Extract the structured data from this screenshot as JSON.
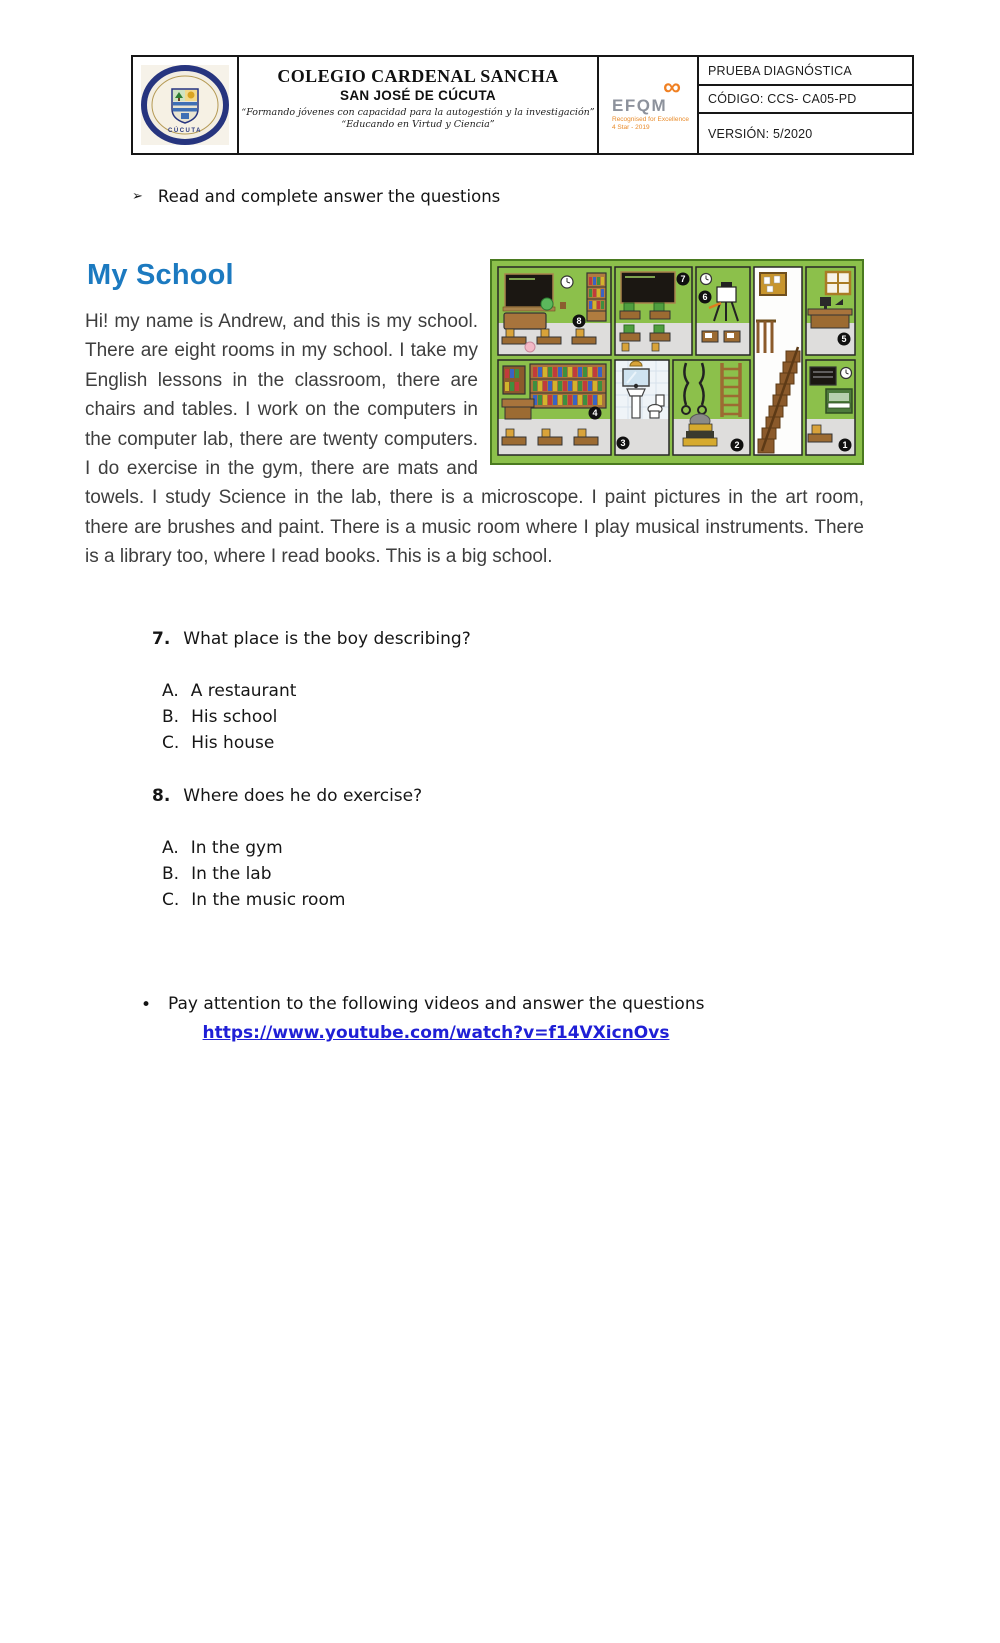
{
  "header": {
    "logo": {
      "top_text": "COLEGIO CARDENAL SANCHA",
      "bottom_text": "CÚCUTA"
    },
    "school_name": "COLEGIO CARDENAL SANCHA",
    "school_city": "SAN JOSÉ DE CÚCUTA",
    "motto_line1": "“Formando jóvenes con capacidad para la autogestión y la investigación”",
    "motto_line2": "“Educando en Virtud y Ciencia”",
    "efqm": {
      "symbol": "∞",
      "label": "EFQM",
      "sub1": "Recognised for Excellence",
      "sub2": "4 Star - 2019"
    },
    "info_rows": [
      "PRUEBA DIAGNÓSTICA",
      "CÓDIGO: CCS- CA05-PD",
      "VERSIÓN: 5/2020"
    ]
  },
  "instruction": {
    "bullet": "➢",
    "text": "Read and complete answer the questions"
  },
  "reading": {
    "title": "My School",
    "paragraph": "Hi! my name is Andrew, and this is my school. There are eight rooms in my school. I take my English lessons in the classroom, there are chairs and tables. I work on the computers in the computer lab, there are twenty computers. I do exercise in the gym, there are mats and towels. I study Science in the lab, there is a microscope. I paint pictures in the art room, there are brushes and paint. There is a music room where I play musical instruments. There is a library too, where I read books. This is a big school."
  },
  "school_image": {
    "room_numbers": [
      "8",
      "7",
      "6",
      "5",
      "4",
      "3",
      "2",
      "1"
    ]
  },
  "questions": [
    {
      "number": "7.",
      "text": "What place is the boy describing?",
      "options": [
        {
          "label": "A.",
          "text": "A restaurant"
        },
        {
          "label": "B.",
          "text": "His school"
        },
        {
          "label": "C.",
          "text": "His house"
        }
      ]
    },
    {
      "number": "8.",
      "text": "Where does he do exercise?",
      "options": [
        {
          "label": "A.",
          "text": "In the gym"
        },
        {
          "label": "B.",
          "text": "In the lab"
        },
        {
          "label": "C.",
          "text": "In the music room"
        }
      ]
    }
  ],
  "video_section": {
    "bullet": "•",
    "text": "Pay attention to the following videos and answer the questions",
    "link_text": "https://www.youtube.com/watch?v=f14VXicnOvs",
    "link_href": "https://www.youtube.com/watch?v=f14VXicnOvs"
  },
  "colors": {
    "title_blue": "#1c7ac0",
    "link_blue": "#1f1fd6",
    "frame_green": "#8cc04b",
    "efqm_orange": "#f08023"
  }
}
